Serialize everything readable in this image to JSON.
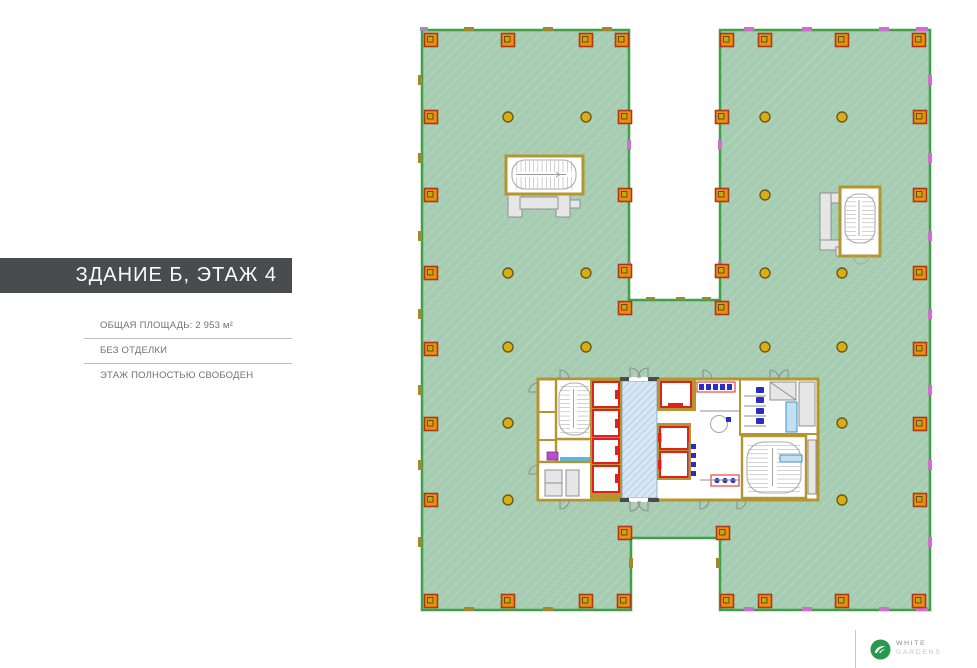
{
  "panel": {
    "title": "ЗДАНИЕ Б, ЭТАЖ 4",
    "info": [
      "ОБЩАЯ ПЛОЩАДЬ: 2 953 м²",
      "БЕЗ ОТДЕЛКИ",
      "ЭТАЖ ПОЛНОСТЬЮ СВОБОДЕН"
    ]
  },
  "logo": {
    "line1": "WHITE",
    "line2": "GARDENS",
    "icon": "white-gardens-leaf-icon"
  },
  "plan": {
    "name": "floor-plan-building-b-floor-4",
    "legend_icons": [
      "perimeter-column-icon",
      "interior-column-icon",
      "elevator-shaft",
      "stairwell",
      "elevator-lobby-hatch",
      "restroom-fixtures"
    ]
  },
  "colors": {
    "floor_fill": "#a6ccb2",
    "floor_hatch": "#bddac5",
    "floor_border": "#3fa048",
    "column_orange": "#ef8d0e",
    "column_border": "#a93a1c",
    "column_inner": "#c9a318",
    "circle_fill": "#d9ad15",
    "circle_border": "#6b5a14",
    "wall_tan": "#b5952f",
    "elevator_red": "#e01f1f",
    "lobby_blue_bg": "#d6e7f5",
    "lobby_blue_line": "#9cc0de",
    "fixture_blue": "#2a2ec6",
    "counter_cyan": "#54b9e8",
    "sink_purple": "#b44fd0",
    "marker_magenta": "#d06ecf",
    "marker_tan": "#a3872f",
    "detail_gray": "#8f9092",
    "title_bar": "#4a4b4d",
    "text_gray": "#717275",
    "rule_gray": "#bcbdbf",
    "logo_green": "#27984c",
    "logo_text_dark": "#8a8b8d",
    "logo_text_light": "#c5c6c8"
  }
}
